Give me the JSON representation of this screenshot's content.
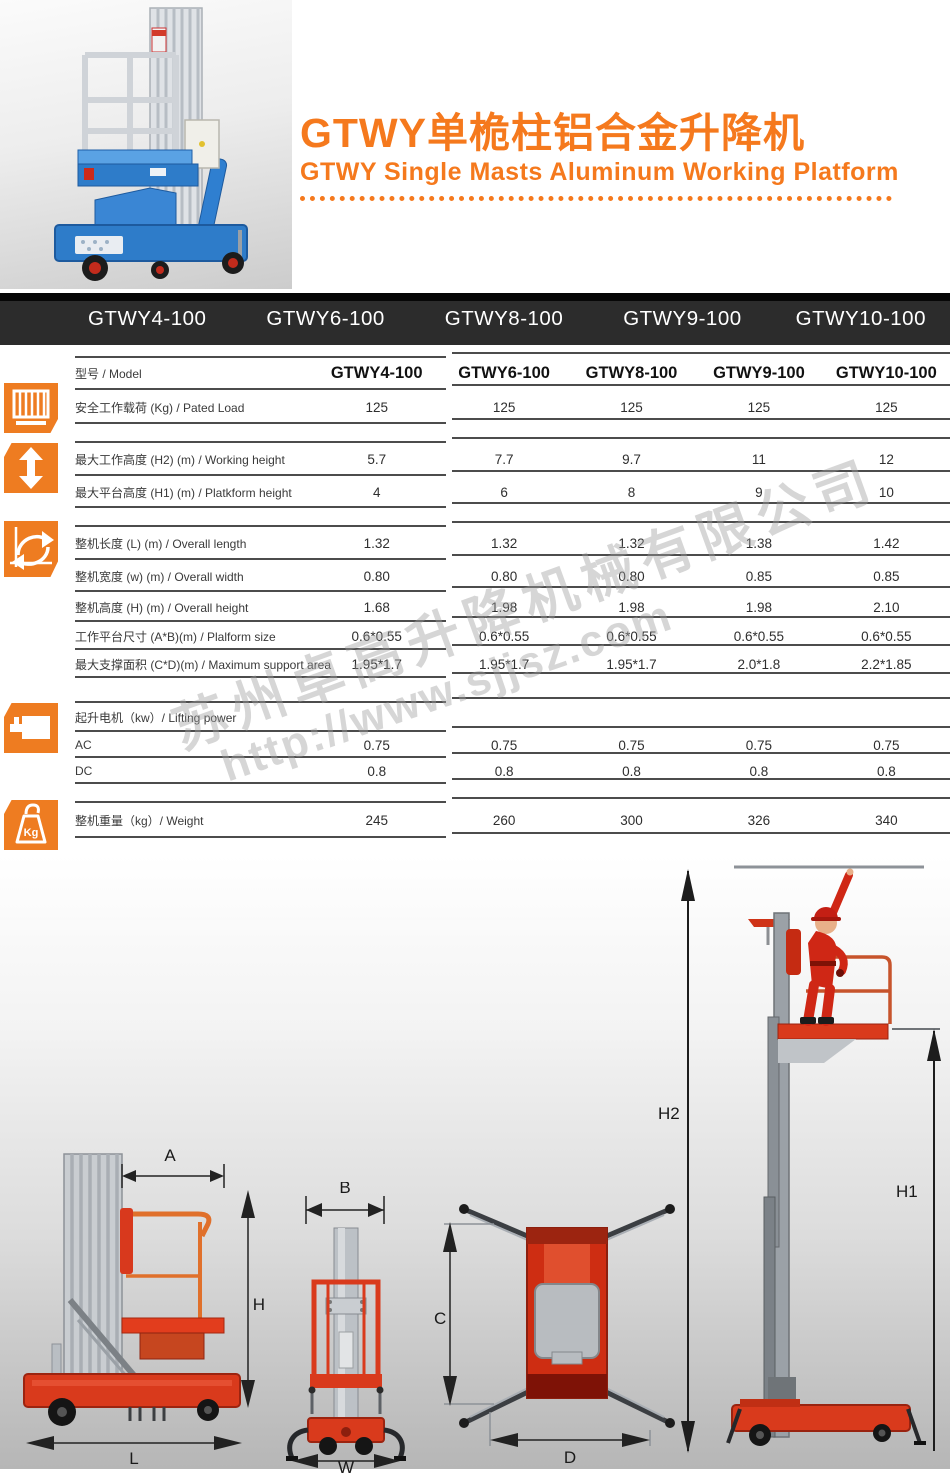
{
  "header": {
    "title_cn": "GTWY单桅柱铝合金升降机",
    "title_en": "GTWY Single Masts Aluminum Working Platform",
    "accent_color": "#f5791d"
  },
  "model_bar": {
    "items": [
      "GTWY4-100",
      "GTWY6-100",
      "GTWY8-100",
      "GTWY9-100",
      "GTWY10-100"
    ]
  },
  "watermark": {
    "company": "苏州卓高升降机械有限公司",
    "url": "http://www.sjjsz.com"
  },
  "table": {
    "rows": [
      {
        "label": "型号 / Model",
        "values": [
          "GTWY4-100",
          "GTWY6-100",
          "GTWY8-100",
          "GTWY9-100",
          "GTWY10-100"
        ],
        "model": true,
        "top": true
      },
      {
        "label": "安全工作载荷 (Kg) / Pated Load",
        "values": [
          "125",
          "125",
          "125",
          "125",
          "125"
        ]
      },
      {
        "label": "最大工作高度 (H2) (m) / Working height",
        "values": [
          "5.7",
          "7.7",
          "9.7",
          "11",
          "12"
        ],
        "top": true
      },
      {
        "label": "最大平台高度 (H1) (m) / Platkform height",
        "values": [
          "4",
          "6",
          "8",
          "9",
          "10"
        ]
      },
      {
        "label": "整机长度 (L) (m) / Overall length",
        "values": [
          "1.32",
          "1.32",
          "1.32",
          "1.38",
          "1.42"
        ],
        "top": true
      },
      {
        "label": "整机宽度 (w) (m) / Overall width",
        "values": [
          "0.80",
          "0.80",
          "0.80",
          "0.85",
          "0.85"
        ]
      },
      {
        "label": "整机高度 (H) (m) / Overall height",
        "values": [
          "1.68",
          "1.98",
          "1.98",
          "1.98",
          "2.10"
        ]
      },
      {
        "label": "工作平台尺寸 (A*B)(m) / Plalform size",
        "values": [
          "0.6*0.55",
          "0.6*0.55",
          "0.6*0.55",
          "0.6*0.55",
          "0.6*0.55"
        ]
      },
      {
        "label": "最大支撑面积 (C*D)(m) / Maximum support area",
        "values": [
          "1.95*1.7",
          "1.95*1.7",
          "1.95*1.7",
          "2.0*1.8",
          "2.2*1.85"
        ]
      },
      {
        "label": "起升电机（kw）/ Lifting power",
        "values": [
          "",
          "",
          "",
          "",
          ""
        ],
        "top": true
      },
      {
        "label": "AC",
        "values": [
          "0.75",
          "0.75",
          "0.75",
          "0.75",
          "0.75"
        ]
      },
      {
        "label": "DC",
        "values": [
          "0.8",
          "0.8",
          "0.8",
          "0.8",
          "0.8"
        ]
      },
      {
        "label": "整机重量（kg）/ Weight",
        "values": [
          "245",
          "260",
          "300",
          "326",
          "340"
        ],
        "top": true
      }
    ]
  },
  "icons": {
    "kg_label": "Kg"
  },
  "diagrams": {
    "labels": {
      "A": "A",
      "H": "H",
      "L": "L",
      "B": "B",
      "W": "W",
      "C": "C",
      "D": "D",
      "H2": "H2",
      "H1": "H1"
    }
  }
}
